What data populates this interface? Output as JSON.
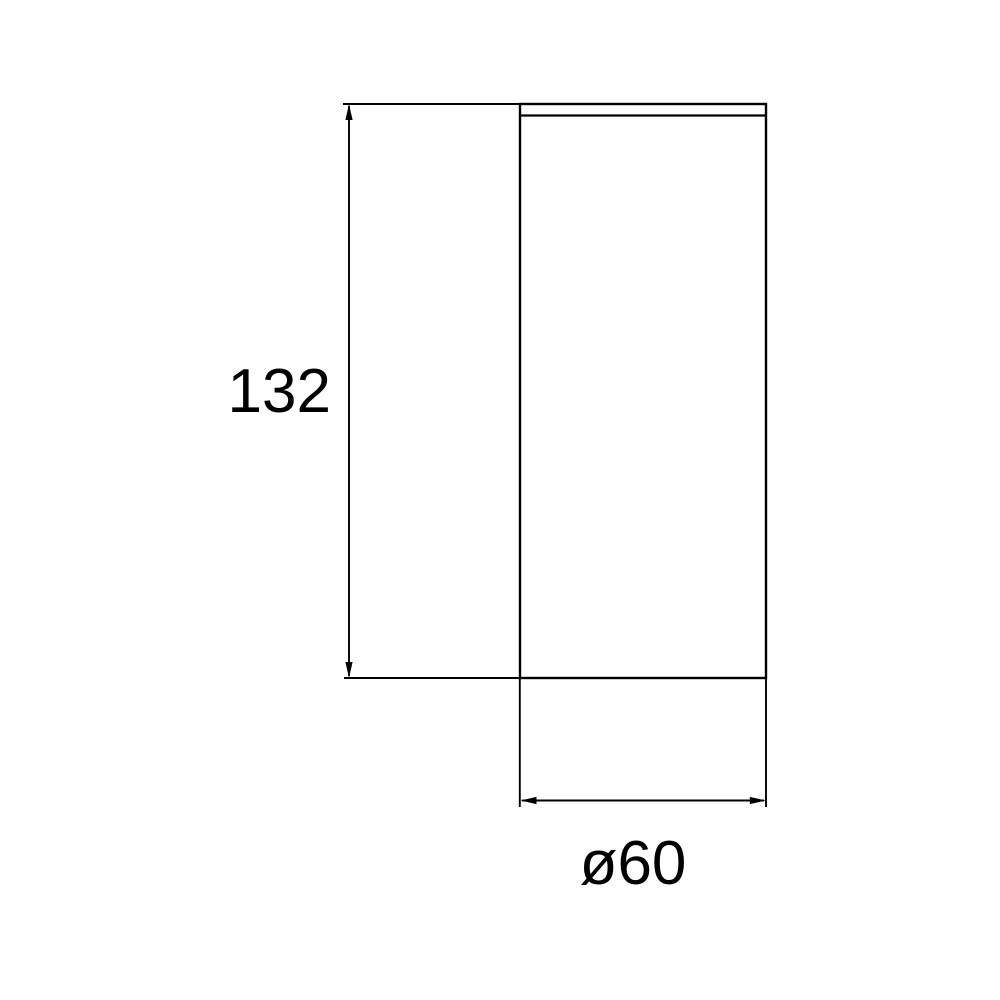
{
  "dimensions": {
    "height": {
      "label": "132",
      "value": 132
    },
    "diameter": {
      "label": "ø60",
      "value": 60
    }
  },
  "style": {
    "line_color": "#000000",
    "text_color": "#000000",
    "background_color": "#ffffff"
  }
}
